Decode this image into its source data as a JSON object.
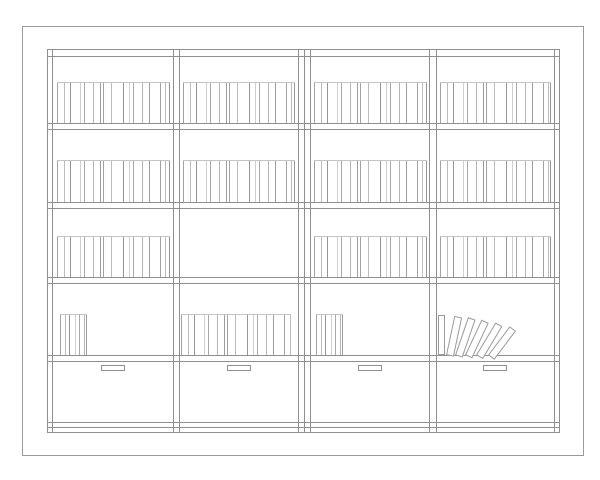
{
  "drawing": {
    "description": "bookshelf-elevation-line-drawing",
    "canvas": {
      "w": 600,
      "h": 480,
      "background": "#ffffff"
    },
    "colors": {
      "structure": "#8f8f8f",
      "page_border": "#9a9a9a",
      "book_top_line": "#c4c4c4",
      "book_shades": [
        "#a2a2a2",
        "#bcbcbc",
        "#969696",
        "#cfcfcf",
        "#a8a8a8",
        "#b4b4b4",
        "#9c9c9c"
      ],
      "leaning_border": "#9a9a9a",
      "handle_border": "#8f8f8f",
      "white": "#ffffff"
    },
    "page_border": {
      "x": 22,
      "y": 26,
      "w": 562,
      "h": 430
    },
    "case": {
      "x0": 47,
      "y0": 49,
      "x1": 560,
      "y1": 432
    },
    "vertical_lines_x": [
      47,
      52,
      173,
      179,
      298,
      304,
      310,
      429,
      436,
      554,
      559
    ],
    "horizontal_lines_y": [
      49,
      56,
      123,
      129,
      202,
      208,
      277,
      283,
      355,
      361,
      422,
      427,
      432
    ],
    "gap_patterns": {
      "wide": [
        7,
        6,
        10,
        4,
        9,
        7,
        3,
        8,
        12,
        6,
        4,
        9,
        7,
        11,
        5,
        8,
        4,
        10,
        6,
        9,
        3,
        7,
        12,
        5,
        8,
        6,
        10,
        4,
        7,
        9
      ],
      "narrow": [
        5,
        4,
        6,
        4,
        5,
        4
      ]
    },
    "book_rows": [
      {
        "top": 82,
        "bottom": 123,
        "runs": [
          {
            "x0": 57,
            "x1": 170,
            "pattern": "wide"
          },
          {
            "x0": 183,
            "x1": 295,
            "pattern": "wide"
          },
          {
            "x0": 314,
            "x1": 427,
            "pattern": "wide"
          },
          {
            "x0": 440,
            "x1": 551,
            "pattern": "wide"
          }
        ]
      },
      {
        "top": 160,
        "bottom": 202,
        "runs": [
          {
            "x0": 57,
            "x1": 170,
            "pattern": "wide"
          },
          {
            "x0": 183,
            "x1": 295,
            "pattern": "wide"
          },
          {
            "x0": 314,
            "x1": 427,
            "pattern": "wide"
          },
          {
            "x0": 440,
            "x1": 551,
            "pattern": "wide"
          }
        ]
      },
      {
        "top": 236,
        "bottom": 277,
        "runs": [
          {
            "x0": 57,
            "x1": 170,
            "pattern": "wide"
          },
          {
            "x0": 314,
            "x1": 427,
            "pattern": "wide"
          },
          {
            "x0": 440,
            "x1": 551,
            "pattern": "wide"
          }
        ]
      },
      {
        "top": 314,
        "bottom": 355,
        "runs": [
          {
            "x0": 60,
            "x1": 87,
            "pattern": "narrow"
          },
          {
            "x0": 181,
            "x1": 291,
            "pattern": "wide"
          },
          {
            "x0": 316,
            "x1": 343,
            "pattern": "narrow"
          }
        ]
      }
    ],
    "leaning_books": {
      "shelf_y": 355,
      "books": [
        {
          "x": 438,
          "w": 7,
          "h": 40,
          "angle": 0
        },
        {
          "x": 446,
          "w": 8,
          "h": 40,
          "angle": 12
        },
        {
          "x": 455,
          "w": 8,
          "h": 40,
          "angle": 19
        },
        {
          "x": 465,
          "w": 8,
          "h": 39,
          "angle": 25
        },
        {
          "x": 476,
          "w": 8,
          "h": 38,
          "angle": 31
        },
        {
          "x": 488,
          "w": 8,
          "h": 36,
          "angle": 37
        }
      ]
    },
    "drawers": {
      "handle": {
        "y": 365,
        "w": 24,
        "h": 6
      },
      "handle_x": [
        101,
        227,
        358,
        483
      ]
    }
  }
}
